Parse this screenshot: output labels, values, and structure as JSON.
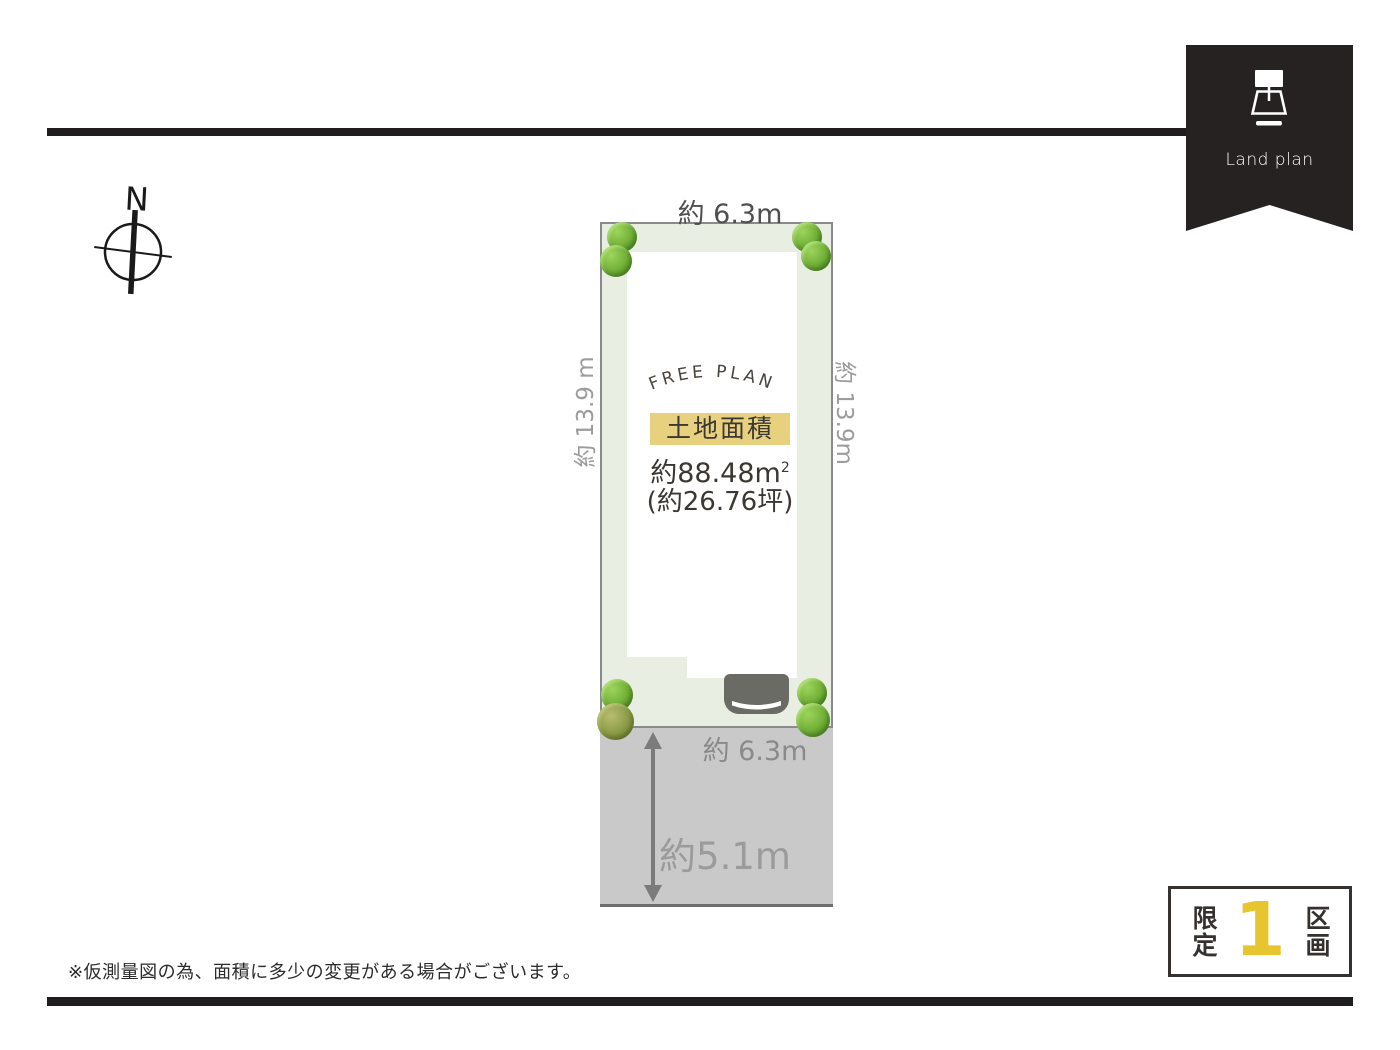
{
  "ribbon": {
    "label": "Land plan"
  },
  "compass": {
    "north_label": "N"
  },
  "plot": {
    "free_plan_text": "FREE PLAN",
    "area_label": "土地面積",
    "area_m2": "約88.48m",
    "area_m2_sup": "2",
    "area_tsubo": "(約26.76坪)",
    "dim_top": "約 6.3m",
    "dim_left": "約 13.9 m",
    "dim_right": "約 13.9m",
    "dim_bottom": "約 6.3m",
    "road_width": "約5.1m"
  },
  "footer": {
    "disclaimer": "※仮測量図の為、面積に多少の変更がある場合がございます。"
  },
  "badge": {
    "prefix": "限定",
    "count": "1",
    "suffix": "区画"
  },
  "colors": {
    "line_black": "#1f1d1d",
    "ribbon_black": "#262221",
    "plot_green": "#e9eee3",
    "road_gray": "#c9c9c9",
    "highlight_yellow": "#e7d07e",
    "badge_yellow": "#e6c52e",
    "tree_green": "#6fae35",
    "car_gray": "#6b6b66"
  }
}
